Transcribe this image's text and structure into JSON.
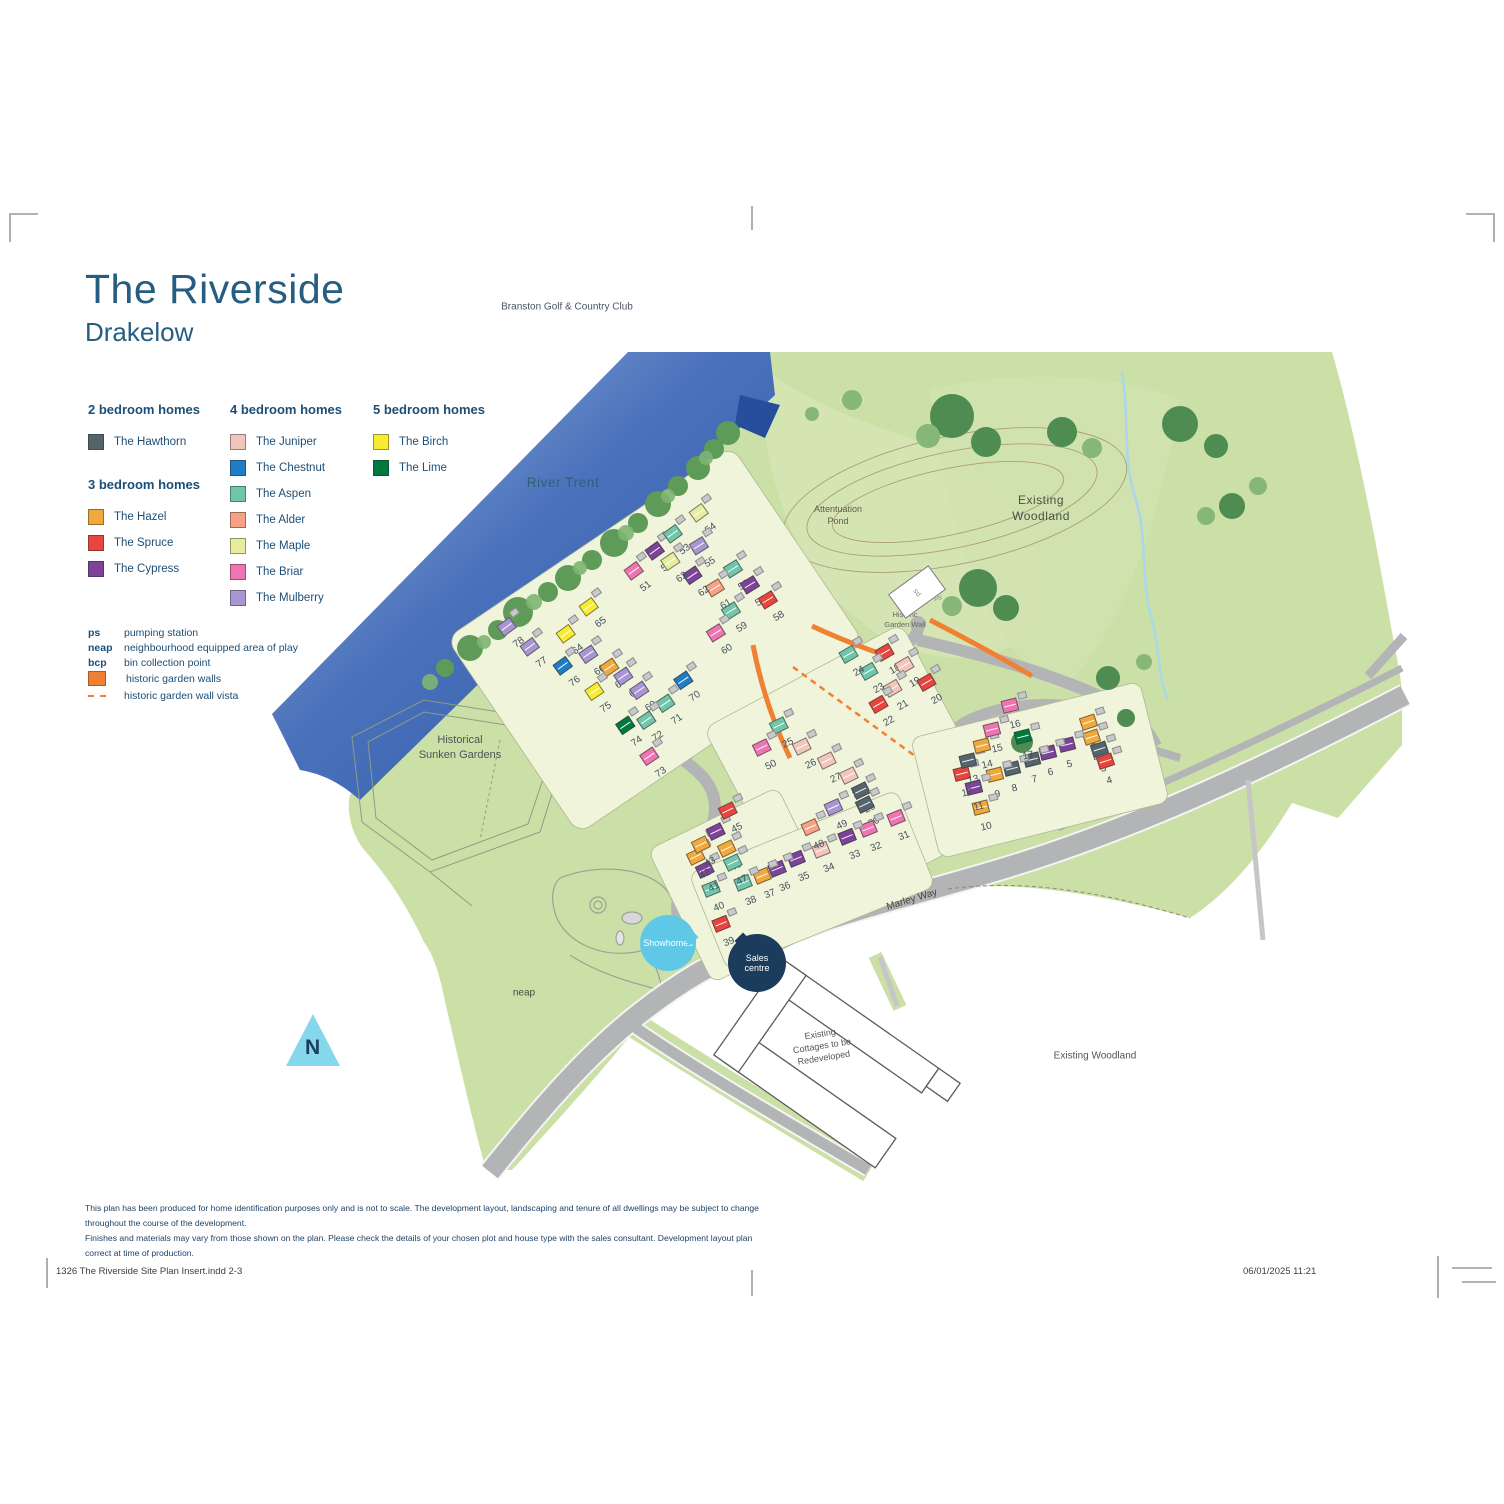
{
  "page": {
    "title": "The Riverside",
    "subtitle": "Drakelow"
  },
  "house_types": {
    "hawthorn": {
      "label": "The Hawthorn",
      "color": "#53646D"
    },
    "hazel": {
      "label": "The Hazel",
      "color": "#F2A93B"
    },
    "spruce": {
      "label": "The Spruce",
      "color": "#E8453F"
    },
    "cypress": {
      "label": "The Cypress",
      "color": "#7C4399"
    },
    "juniper": {
      "label": "The Juniper",
      "color": "#F3C6BC"
    },
    "chestnut": {
      "label": "The Chestnut",
      "color": "#1F7DC5"
    },
    "aspen": {
      "label": "The Aspen",
      "color": "#70C6AA"
    },
    "alder": {
      "label": "The Alder",
      "color": "#F5A285"
    },
    "maple": {
      "label": "The Maple",
      "color": "#E7EC9F"
    },
    "briar": {
      "label": "The Briar",
      "color": "#EE74B2"
    },
    "mulberry": {
      "label": "The Mulberry",
      "color": "#A895D2"
    },
    "birch": {
      "label": "The Birch",
      "color": "#F8EC33"
    },
    "lime": {
      "label": "The Lime",
      "color": "#00793F"
    }
  },
  "legend": {
    "groups": [
      {
        "heading": "2 bedroom homes",
        "types": [
          "hawthorn"
        ],
        "column": 1
      },
      {
        "heading": "3 bedroom homes",
        "types": [
          "hazel",
          "spruce",
          "cypress"
        ],
        "column": 1
      },
      {
        "heading": "4 bedroom homes",
        "types": [
          "juniper",
          "chestnut",
          "aspen",
          "alder",
          "maple",
          "briar",
          "mulberry"
        ],
        "column": 2
      },
      {
        "heading": "5 bedroom homes",
        "types": [
          "birch",
          "lime"
        ],
        "column": 3
      }
    ],
    "abbreviations": [
      {
        "abbr": "ps",
        "label": "pumping station"
      },
      {
        "abbr": "neap",
        "label": "neighbourhood equipped area of play"
      },
      {
        "abbr": "bcp",
        "label": "bin collection point"
      }
    ],
    "symbols": [
      {
        "kind": "swatch",
        "color": "#F08133",
        "label": "historic garden walls"
      },
      {
        "kind": "dash",
        "color": "#F08133",
        "label": "historic garden wall vista"
      }
    ]
  },
  "map": {
    "labels": [
      {
        "id": "branston-golf-club",
        "lines": [
          "Branston Golf & Country Club"
        ],
        "x": 567,
        "y": 307,
        "size": 10,
        "color": "#4A5568"
      },
      {
        "id": "river-trent",
        "lines": [
          "River Trent"
        ],
        "x": 563,
        "y": 483,
        "size": 13.5,
        "color": "#2E6077",
        "spacing": 0.6
      },
      {
        "id": "existing-woodland-top",
        "lines": [
          "Existing",
          "Woodland"
        ],
        "x": 1041,
        "y": 508,
        "size": 12,
        "color": "#47524C",
        "spacing": 0.5
      },
      {
        "id": "attenuation-pond",
        "lines": [
          "Attentuation",
          "Pond"
        ],
        "x": 838,
        "y": 515,
        "size": 9,
        "color": "#5D5D4E"
      },
      {
        "id": "historic-garden-wall",
        "lines": [
          "Historic",
          "Garden Wall"
        ],
        "x": 905,
        "y": 620,
        "size": 7.5,
        "color": "#6B675A"
      },
      {
        "id": "historical-sunken-gardens",
        "lines": [
          "Historical",
          "Sunken Gardens"
        ],
        "x": 460,
        "y": 748,
        "size": 11,
        "color": "#4A5456"
      },
      {
        "id": "neap-area",
        "lines": [
          "neap"
        ],
        "x": 524,
        "y": 993,
        "size": 10,
        "color": "#4A4A40"
      },
      {
        "id": "marley-way",
        "lines": [
          "Marley Way"
        ],
        "x": 912,
        "y": 900,
        "size": 10,
        "color": "#474740",
        "rotate": -17
      },
      {
        "id": "existing-cottages",
        "lines": [
          "Existing",
          "Cottages to be",
          "Redeveloped"
        ],
        "x": 822,
        "y": 1046,
        "size": 9,
        "color": "#555555",
        "rotate": -9
      },
      {
        "id": "existing-woodland-bottom",
        "lines": [
          "Existing Woodland"
        ],
        "x": 1095,
        "y": 1056,
        "size": 10,
        "color": "#555555"
      },
      {
        "id": "ps-label",
        "lines": [
          "ps"
        ],
        "x": 938,
        "y": 598,
        "size": 7,
        "color": "#8a8a8c"
      }
    ],
    "bubbles": [
      {
        "id": "showhomes",
        "lines": [
          "Showhomes"
        ],
        "x": 668,
        "y": 943,
        "d": 56,
        "bg": "#5FC8E6",
        "color": "#ffffff",
        "size": 9,
        "tail": {
          "dx": 22,
          "dy": -6
        }
      },
      {
        "id": "sales-centre",
        "lines": [
          "Sales",
          "centre"
        ],
        "x": 757,
        "y": 963,
        "d": 58,
        "bg": "#1B3C5C",
        "color": "#ffffff",
        "size": 9,
        "tail": {
          "dx": -14,
          "dy": -22
        }
      }
    ],
    "compass": {
      "letter": "N",
      "x": 313,
      "y": 1040
    },
    "plots": [
      {
        "n": 1,
        "x": 1097,
        "y": 742,
        "r": -18,
        "t": "hazel"
      },
      {
        "n": 2,
        "x": 1100,
        "y": 757,
        "r": -18,
        "t": "hazel"
      },
      {
        "n": 3,
        "x": 1108,
        "y": 769,
        "r": -18,
        "t": "hawthorn"
      },
      {
        "n": 4,
        "x": 1114,
        "y": 781,
        "r": -18,
        "t": "spruce"
      },
      {
        "n": 5,
        "x": 1074,
        "y": 765,
        "r": -14,
        "t": "cypress"
      },
      {
        "n": 6,
        "x": 1055,
        "y": 773,
        "r": -14,
        "t": "cypress"
      },
      {
        "n": 7,
        "x": 1039,
        "y": 780,
        "r": -14,
        "t": "hawthorn"
      },
      {
        "n": 8,
        "x": 1019,
        "y": 789,
        "r": -14,
        "t": "hawthorn"
      },
      {
        "n": 9,
        "x": 1002,
        "y": 795,
        "r": -14,
        "t": "hazel"
      },
      {
        "n": 10,
        "x": 988,
        "y": 828,
        "r": -14,
        "t": "hazel"
      },
      {
        "n": 11,
        "x": 981,
        "y": 808,
        "r": -14,
        "t": "cypress"
      },
      {
        "n": 12,
        "x": 969,
        "y": 794,
        "r": -14,
        "t": "spruce"
      },
      {
        "n": 13,
        "x": 975,
        "y": 781,
        "r": -14,
        "t": "hawthorn"
      },
      {
        "n": 14,
        "x": 989,
        "y": 766,
        "r": -14,
        "t": "hazel"
      },
      {
        "n": 15,
        "x": 999,
        "y": 750,
        "r": -14,
        "t": "briar"
      },
      {
        "n": 16,
        "x": 1017,
        "y": 726,
        "r": -14,
        "t": "briar"
      },
      {
        "n": 17,
        "x": 1030,
        "y": 757,
        "r": -14,
        "t": "lime"
      },
      {
        "n": 18,
        "x": 897,
        "y": 670,
        "r": -30,
        "t": "spruce"
      },
      {
        "n": 19,
        "x": 917,
        "y": 683,
        "r": -30,
        "t": "juniper"
      },
      {
        "n": 20,
        "x": 939,
        "y": 700,
        "r": -30,
        "t": "spruce"
      },
      {
        "n": 21,
        "x": 905,
        "y": 706,
        "r": -30,
        "t": "juniper"
      },
      {
        "n": 22,
        "x": 891,
        "y": 722,
        "r": -30,
        "t": "spruce"
      },
      {
        "n": 23,
        "x": 881,
        "y": 689,
        "r": -30,
        "t": "aspen"
      },
      {
        "n": 24,
        "x": 861,
        "y": 672,
        "r": -30,
        "t": "aspen"
      },
      {
        "n": 25,
        "x": 790,
        "y": 744,
        "r": -26,
        "t": "aspen"
      },
      {
        "n": 26,
        "x": 813,
        "y": 765,
        "r": -26,
        "t": "juniper"
      },
      {
        "n": 27,
        "x": 838,
        "y": 779,
        "r": -26,
        "t": "juniper"
      },
      {
        "n": 28,
        "x": 860,
        "y": 794,
        "r": -26,
        "t": "juniper"
      },
      {
        "n": 29,
        "x": 872,
        "y": 809,
        "r": -26,
        "t": "hawthorn"
      },
      {
        "n": 30,
        "x": 876,
        "y": 823,
        "r": -26,
        "t": "hawthorn"
      },
      {
        "n": 31,
        "x": 906,
        "y": 837,
        "r": -22,
        "t": "briar"
      },
      {
        "n": 32,
        "x": 878,
        "y": 848,
        "r": -22,
        "t": "briar"
      },
      {
        "n": 33,
        "x": 857,
        "y": 856,
        "r": -22,
        "t": "cypress"
      },
      {
        "n": 34,
        "x": 831,
        "y": 869,
        "r": -22,
        "t": "juniper"
      },
      {
        "n": 35,
        "x": 806,
        "y": 878,
        "r": -22,
        "t": "cypress"
      },
      {
        "n": 36,
        "x": 787,
        "y": 888,
        "r": -22,
        "t": "cypress"
      },
      {
        "n": 37,
        "x": 772,
        "y": 895,
        "r": -22,
        "t": "hazel"
      },
      {
        "n": 38,
        "x": 753,
        "y": 902,
        "r": -22,
        "t": "aspen"
      },
      {
        "n": 39,
        "x": 731,
        "y": 943,
        "r": -22,
        "t": "spruce"
      },
      {
        "n": 40,
        "x": 721,
        "y": 908,
        "r": -22,
        "t": "aspen"
      },
      {
        "n": 41,
        "x": 716,
        "y": 888,
        "r": -26,
        "t": "cypress"
      },
      {
        "n": 42,
        "x": 707,
        "y": 875,
        "r": -26,
        "t": "hazel"
      },
      {
        "n": 43,
        "x": 712,
        "y": 863,
        "r": -26,
        "t": "hazel"
      },
      {
        "n": 44,
        "x": 727,
        "y": 850,
        "r": -26,
        "t": "cypress"
      },
      {
        "n": 45,
        "x": 739,
        "y": 829,
        "r": -26,
        "t": "spruce"
      },
      {
        "n": 46,
        "x": 738,
        "y": 867,
        "r": -26,
        "t": "hazel"
      },
      {
        "n": 47,
        "x": 744,
        "y": 881,
        "r": -26,
        "t": "aspen"
      },
      {
        "n": 48,
        "x": 821,
        "y": 846,
        "r": -24,
        "t": "alder"
      },
      {
        "n": 49,
        "x": 844,
        "y": 826,
        "r": -24,
        "t": "mulberry"
      },
      {
        "n": 50,
        "x": 773,
        "y": 766,
        "r": -26,
        "t": "briar"
      },
      {
        "n": 51,
        "x": 648,
        "y": 587,
        "r": -36,
        "t": "briar"
      },
      {
        "n": 52,
        "x": 669,
        "y": 567,
        "r": -36,
        "t": "cypress"
      },
      {
        "n": 53,
        "x": 687,
        "y": 550,
        "r": -36,
        "t": "aspen"
      },
      {
        "n": 54,
        "x": 713,
        "y": 529,
        "r": -36,
        "t": "maple"
      },
      {
        "n": 55,
        "x": 712,
        "y": 563,
        "r": -32,
        "t": "mulberry"
      },
      {
        "n": 56,
        "x": 746,
        "y": 586,
        "r": -32,
        "t": "aspen"
      },
      {
        "n": 57,
        "x": 763,
        "y": 602,
        "r": -32,
        "t": "cypress"
      },
      {
        "n": 58,
        "x": 781,
        "y": 617,
        "r": -32,
        "t": "spruce"
      },
      {
        "n": 59,
        "x": 744,
        "y": 628,
        "r": -32,
        "t": "aspen"
      },
      {
        "n": 60,
        "x": 729,
        "y": 650,
        "r": -32,
        "t": "briar"
      },
      {
        "n": 61,
        "x": 728,
        "y": 605,
        "r": -32,
        "t": "alder"
      },
      {
        "n": 62,
        "x": 706,
        "y": 592,
        "r": -34,
        "t": "cypress"
      },
      {
        "n": 63,
        "x": 684,
        "y": 578,
        "r": -34,
        "t": "maple"
      },
      {
        "n": 64,
        "x": 580,
        "y": 650,
        "r": -36,
        "t": "birch"
      },
      {
        "n": 65,
        "x": 603,
        "y": 623,
        "r": -36,
        "t": "birch"
      },
      {
        "n": 66,
        "x": 602,
        "y": 671,
        "r": -34,
        "t": "mulberry"
      },
      {
        "n": 67,
        "x": 623,
        "y": 684,
        "r": -34,
        "t": "hazel"
      },
      {
        "n": 68,
        "x": 637,
        "y": 693,
        "r": -34,
        "t": "mulberry"
      },
      {
        "n": 69,
        "x": 653,
        "y": 707,
        "r": -34,
        "t": "mulberry"
      },
      {
        "n": 70,
        "x": 697,
        "y": 697,
        "r": -34,
        "t": "chestnut"
      },
      {
        "n": 71,
        "x": 679,
        "y": 720,
        "r": -34,
        "t": "aspen"
      },
      {
        "n": 72,
        "x": 660,
        "y": 737,
        "r": -34,
        "t": "aspen"
      },
      {
        "n": 73,
        "x": 663,
        "y": 773,
        "r": -34,
        "t": "briar"
      },
      {
        "n": 74,
        "x": 639,
        "y": 742,
        "r": -34,
        "t": "lime"
      },
      {
        "n": 75,
        "x": 608,
        "y": 708,
        "r": -34,
        "t": "birch"
      },
      {
        "n": 76,
        "x": 577,
        "y": 682,
        "r": -36,
        "t": "chestnut"
      },
      {
        "n": 77,
        "x": 544,
        "y": 663,
        "r": -36,
        "t": "mulberry"
      },
      {
        "n": 78,
        "x": 521,
        "y": 643,
        "r": -36,
        "t": "mulberry"
      }
    ]
  },
  "footer": {
    "disclaimer_line1": "This plan has been produced for home identification purposes only and is not to scale. The development layout, landscaping and tenure of all dwellings may be subject to change throughout the course of the development.",
    "disclaimer_line2": "Finishes and materials may vary from those shown on the plan. Please check the details of your chosen plot and house type with the sales consultant. Development layout plan correct at time of production.",
    "print_left": "1326 The Riverside Site Plan Insert.indd   2-3",
    "print_right": "06/01/2025   11:21"
  }
}
